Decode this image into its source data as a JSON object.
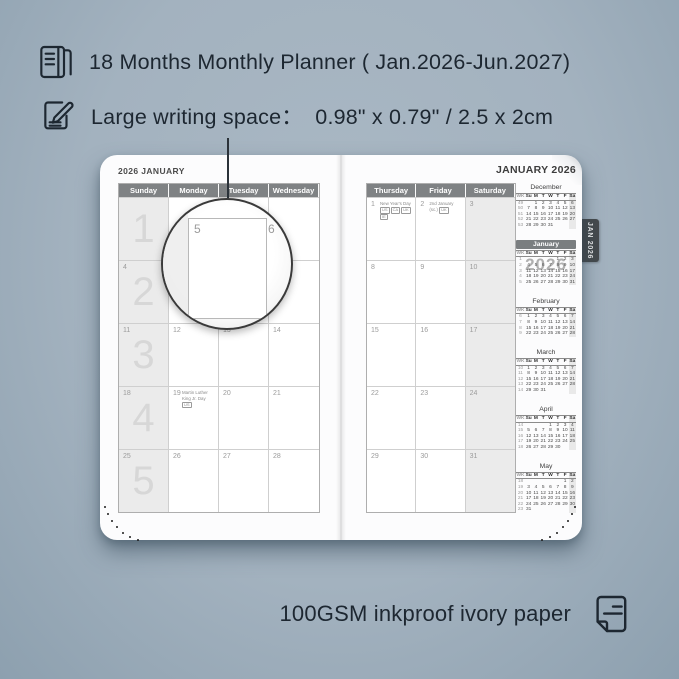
{
  "colors": {
    "background": "#a3b2bf",
    "ink": "#1d2731",
    "grid_header_bg": "#7f8284",
    "shaded_column": "#ebebeb",
    "tab_bg": "#45494c",
    "mini_current_header_bg": "#7a7e80"
  },
  "features": {
    "top": [
      {
        "icon": "planner-book-icon",
        "text": "18 Months Monthly Planner ( Jan.2026-Jun.2027)"
      },
      {
        "icon": "pencil-note-icon",
        "text": "Large writing space：  0.98\" x 0.79\" / 2.5 x 2cm"
      }
    ],
    "bottom": {
      "icon": "paper-sheet-icon",
      "text": "100GSM inkproof ivory paper"
    }
  },
  "planner": {
    "left_page": {
      "title": "2026 JANUARY",
      "day_headers": [
        "Sunday",
        "Monday",
        "Tuesday",
        "Wednesday"
      ],
      "weeks": [
        {
          "week_big": "1",
          "days": [
            "",
            "",
            "",
            ""
          ]
        },
        {
          "week_big": "2",
          "days": [
            "4",
            "5",
            "6",
            "7"
          ]
        },
        {
          "week_big": "3",
          "days": [
            "11",
            "12",
            "13",
            "14"
          ]
        },
        {
          "week_big": "4",
          "days": [
            "18",
            "19",
            "20",
            "21"
          ]
        },
        {
          "week_big": "5",
          "days": [
            "25",
            "26",
            "27",
            "28"
          ]
        }
      ],
      "holidays": [
        {
          "date": "19",
          "name": "Martin Luther King Jr. Day",
          "badges": [
            "US"
          ]
        }
      ]
    },
    "right_page": {
      "title": "JANUARY 2026",
      "day_headers": [
        "Thursday",
        "Friday",
        "Saturday"
      ],
      "weeks": [
        [
          "1",
          "2",
          "3"
        ],
        [
          "8",
          "9",
          "10"
        ],
        [
          "15",
          "16",
          "17"
        ],
        [
          "22",
          "23",
          "24"
        ],
        [
          "29",
          "30",
          "31"
        ]
      ],
      "holidays": [
        {
          "date": "1",
          "name": "New Year's Day",
          "badges": [
            "US",
            "CA",
            "UK",
            "IE"
          ]
        },
        {
          "date": "2",
          "name": "2nd January (sc.)",
          "badges": [
            "UK"
          ]
        }
      ],
      "watermark": "2026",
      "tab_label": "JAN 2026"
    },
    "mini_calendar": {
      "header": [
        "WK",
        "Su",
        "M",
        "T",
        "W",
        "T",
        "F",
        "Sa"
      ],
      "months": [
        {
          "name": "December",
          "current": false,
          "rows": [
            [
              "49",
              "",
              "1",
              "2",
              "3",
              "4",
              "5",
              "6"
            ],
            [
              "50",
              "7",
              "8",
              "9",
              "10",
              "11",
              "12",
              "13"
            ],
            [
              "51",
              "14",
              "15",
              "16",
              "17",
              "18",
              "19",
              "20"
            ],
            [
              "52",
              "21",
              "22",
              "23",
              "24",
              "25",
              "26",
              "27"
            ],
            [
              "53",
              "28",
              "29",
              "30",
              "31",
              "",
              "",
              ""
            ]
          ]
        },
        {
          "name": "January",
          "current": true,
          "rows": [
            [
              "1",
              "",
              "",
              "",
              "",
              "1",
              "2",
              "3"
            ],
            [
              "2",
              "4",
              "5",
              "6",
              "7",
              "8",
              "9",
              "10"
            ],
            [
              "3",
              "11",
              "12",
              "13",
              "14",
              "15",
              "16",
              "17"
            ],
            [
              "4",
              "18",
              "19",
              "20",
              "21",
              "22",
              "23",
              "24"
            ],
            [
              "5",
              "25",
              "26",
              "27",
              "28",
              "29",
              "30",
              "31"
            ]
          ]
        },
        {
          "name": "February",
          "current": false,
          "rows": [
            [
              "6",
              "1",
              "2",
              "3",
              "4",
              "5",
              "6",
              "7"
            ],
            [
              "7",
              "8",
              "9",
              "10",
              "11",
              "12",
              "13",
              "14"
            ],
            [
              "8",
              "15",
              "16",
              "17",
              "18",
              "19",
              "20",
              "21"
            ],
            [
              "9",
              "22",
              "23",
              "24",
              "25",
              "26",
              "27",
              "28"
            ]
          ]
        },
        {
          "name": "March",
          "current": false,
          "rows": [
            [
              "10",
              "1",
              "2",
              "3",
              "4",
              "5",
              "6",
              "7"
            ],
            [
              "11",
              "8",
              "9",
              "10",
              "11",
              "12",
              "13",
              "14"
            ],
            [
              "12",
              "15",
              "16",
              "17",
              "18",
              "19",
              "20",
              "21"
            ],
            [
              "13",
              "22",
              "23",
              "24",
              "25",
              "26",
              "27",
              "28"
            ],
            [
              "14",
              "29",
              "30",
              "31",
              "",
              "",
              "",
              ""
            ]
          ]
        },
        {
          "name": "April",
          "current": false,
          "rows": [
            [
              "14",
              "",
              "",
              "",
              "1",
              "2",
              "3",
              "4"
            ],
            [
              "15",
              "5",
              "6",
              "7",
              "8",
              "9",
              "10",
              "11"
            ],
            [
              "16",
              "12",
              "13",
              "14",
              "15",
              "16",
              "17",
              "18"
            ],
            [
              "17",
              "19",
              "20",
              "21",
              "22",
              "23",
              "24",
              "25"
            ],
            [
              "18",
              "26",
              "27",
              "28",
              "29",
              "30",
              "",
              ""
            ]
          ]
        },
        {
          "name": "May",
          "current": false,
          "rows": [
            [
              "18",
              "",
              "",
              "",
              "",
              "",
              "1",
              "2"
            ],
            [
              "19",
              "3",
              "4",
              "5",
              "6",
              "7",
              "8",
              "9"
            ],
            [
              "20",
              "10",
              "11",
              "12",
              "13",
              "14",
              "15",
              "16"
            ],
            [
              "21",
              "17",
              "18",
              "19",
              "20",
              "21",
              "22",
              "23"
            ],
            [
              "22",
              "24",
              "25",
              "26",
              "27",
              "28",
              "29",
              "30"
            ],
            [
              "23",
              "31",
              "",
              "",
              "",
              "",
              "",
              ""
            ]
          ]
        }
      ]
    }
  },
  "lens": {
    "day": "5",
    "next_day": "6"
  }
}
